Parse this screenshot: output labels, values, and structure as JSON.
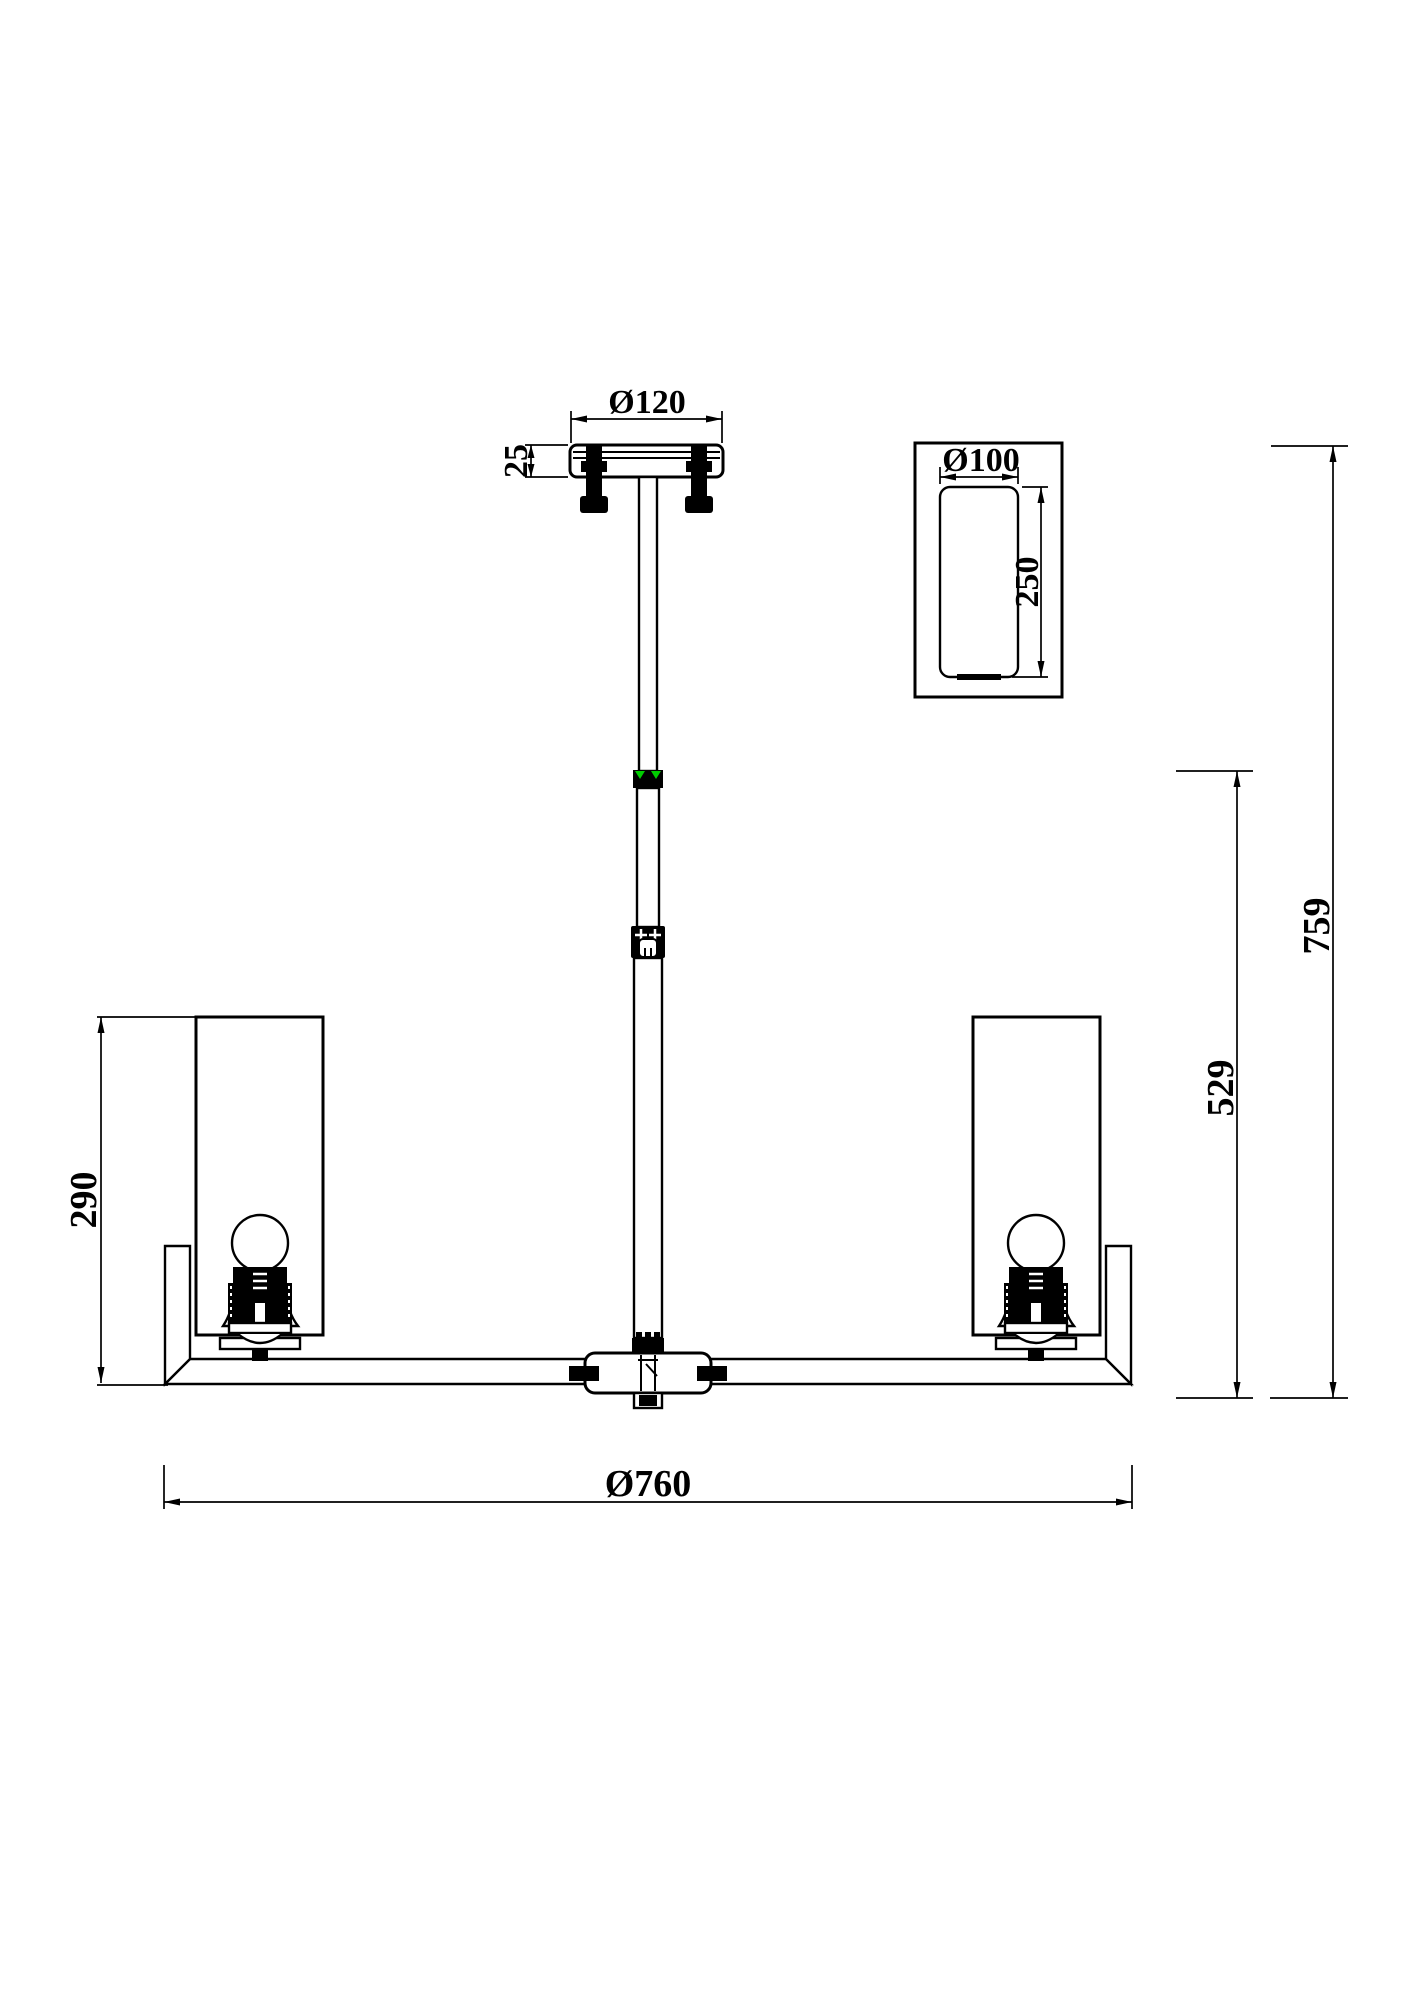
{
  "page": {
    "background": "#ffffff"
  },
  "drawing": {
    "type": "technical-dimension-drawing",
    "subject": "ceiling chandelier with cylindrical glass shades",
    "line_color": "#000000",
    "joint_marker_color": "#00cc00",
    "dimensions": {
      "canopy_diameter": "Ø120",
      "canopy_height": "25",
      "fixture_diameter": "Ø760",
      "total_height": "759",
      "body_height": "529",
      "shade_assembly_height": "290",
      "detail_shade_diameter": "Ø100",
      "detail_shade_height": "250"
    }
  }
}
